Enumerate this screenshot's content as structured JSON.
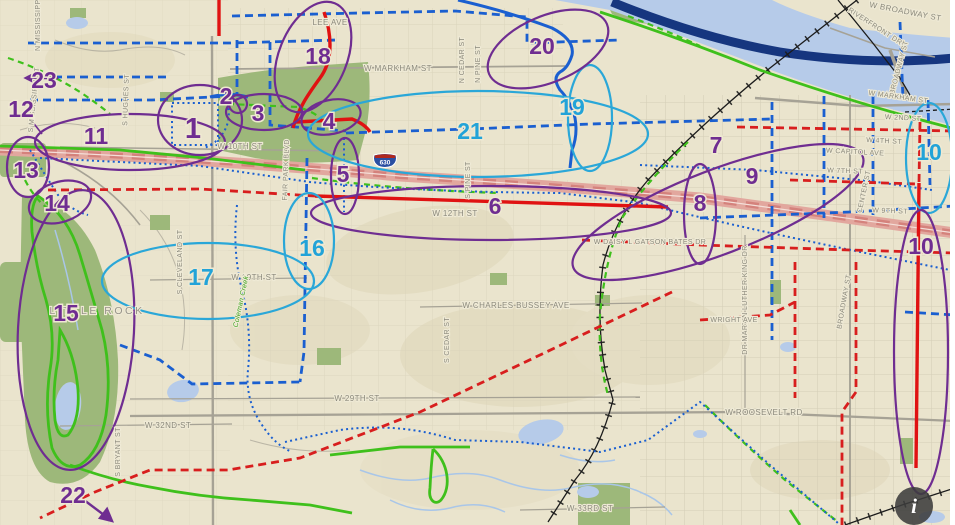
{
  "map": {
    "city_label": "LITTLE ROCK",
    "creek_label": "Coleman Creek",
    "shield_label": "630",
    "info_label": "i"
  },
  "colors": {
    "annotation_purple": "#6f2d91",
    "annotation_cyan": "#22a3d8",
    "route_blue": "#1a5fd0",
    "route_red": "#d81e1e",
    "route_green": "#3fc01c",
    "river_navy": "#16367f",
    "freeway_pink": "#e2a79e",
    "map_base_tan": "#eae4cd",
    "park_green": "#9db87a"
  },
  "annotations": [
    {
      "label": "1",
      "color": "purple"
    },
    {
      "label": "2",
      "color": "purple"
    },
    {
      "label": "3",
      "color": "purple"
    },
    {
      "label": "4",
      "color": "purple"
    },
    {
      "label": "5",
      "color": "purple"
    },
    {
      "label": "6",
      "color": "purple"
    },
    {
      "label": "7",
      "color": "purple"
    },
    {
      "label": "8",
      "color": "purple"
    },
    {
      "label": "9",
      "color": "purple"
    },
    {
      "label": "10",
      "color": "cyan"
    },
    {
      "label": "10",
      "color": "purple"
    },
    {
      "label": "11",
      "color": "purple"
    },
    {
      "label": "12",
      "color": "purple"
    },
    {
      "label": "13",
      "color": "purple"
    },
    {
      "label": "14",
      "color": "purple"
    },
    {
      "label": "15",
      "color": "purple"
    },
    {
      "label": "16",
      "color": "cyan"
    },
    {
      "label": "17",
      "color": "cyan"
    },
    {
      "label": "18",
      "color": "purple"
    },
    {
      "label": "19",
      "color": "cyan"
    },
    {
      "label": "20",
      "color": "purple"
    },
    {
      "label": "21",
      "color": "cyan"
    },
    {
      "label": "22",
      "color": "purple"
    },
    {
      "label": "23",
      "color": "purple"
    }
  ],
  "streets": [
    {
      "label": "LEE AVE"
    },
    {
      "label": "W MARKHAM ST"
    },
    {
      "label": "N CEDAR ST"
    },
    {
      "label": "N PINE ST"
    },
    {
      "label": "W BROADWAY ST"
    },
    {
      "label": "RIVERFRONT DR"
    },
    {
      "label": "BROADWAY ST"
    },
    {
      "label": "W MARKHAM ST"
    },
    {
      "label": "W 2ND ST"
    },
    {
      "label": "W 4TH ST"
    },
    {
      "label": "W CAPITOL AVE"
    },
    {
      "label": "W 7TH ST"
    },
    {
      "label": "W 9TH ST"
    },
    {
      "label": "CENTER ST"
    },
    {
      "label": "BROADWAY ST"
    },
    {
      "label": "W 10TH ST"
    },
    {
      "label": "S PINE ST"
    },
    {
      "label": "W 12TH ST"
    },
    {
      "label": "S CLEVELAND ST"
    },
    {
      "label": "W 19TH ST"
    },
    {
      "label": "W CHARLES BUSSEY AVE"
    },
    {
      "label": "W 29TH ST"
    },
    {
      "label": "W 32ND ST"
    },
    {
      "label": "S BRYANT ST"
    },
    {
      "label": "S CEDAR ST"
    },
    {
      "label": "S MISSISSIPPI ST"
    },
    {
      "label": "S HUGHES ST"
    },
    {
      "label": "FAIR PARK BLVD"
    },
    {
      "label": "W ROOSEVELT RD"
    },
    {
      "label": "W 33RD ST"
    },
    {
      "label": "DR MARTIN LUTHER KING DR"
    },
    {
      "label": "WRIGHT AVE"
    },
    {
      "label": "W DAISY L GATSON BATES DR"
    },
    {
      "label": "N MISSISSIPPI ST"
    }
  ]
}
